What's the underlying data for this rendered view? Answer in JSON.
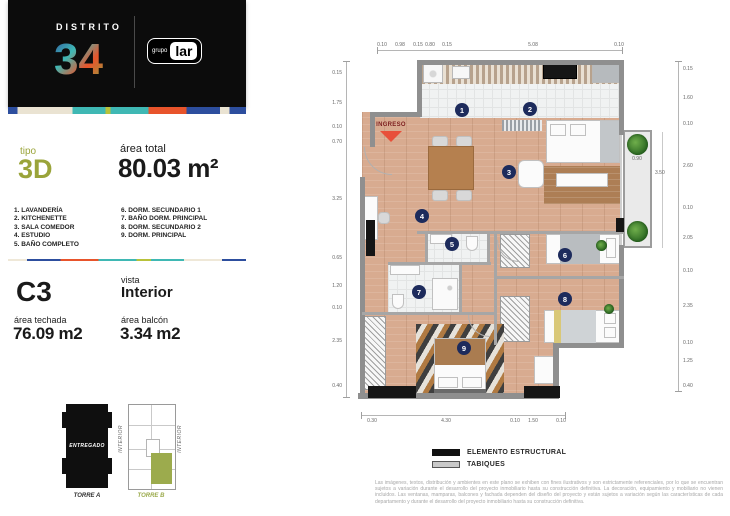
{
  "header": {
    "brand_top": "DISTRITO",
    "brand_number": "34",
    "partner_small": "grupo",
    "partner_main": "lar"
  },
  "summary": {
    "tipo_label": "tipo",
    "tipo_value": "3D",
    "area_total_label": "área total",
    "area_total_value": "80.03 m²"
  },
  "rooms_col1": [
    {
      "num": "1.",
      "name": "LAVANDERÍA"
    },
    {
      "num": "2.",
      "name": "KITCHENETTE"
    },
    {
      "num": "3.",
      "name": "SALA COMEDOR"
    },
    {
      "num": "4.",
      "name": "ESTUDIO"
    },
    {
      "num": "5.",
      "name": "BAÑO COMPLETO"
    }
  ],
  "rooms_col2": [
    {
      "num": "6.",
      "name": "DORM. SECUNDARIO 1"
    },
    {
      "num": "7.",
      "name": "BAÑO DORM. PRINCIPAL"
    },
    {
      "num": "8.",
      "name": "DORM. SECUNDARIO 2"
    },
    {
      "num": "9.",
      "name": "DORM. PRINCIPAL"
    }
  ],
  "unit": {
    "code": "C3",
    "vista_label": "vista",
    "vista_value": "Interior",
    "area_techada_label": "área techada",
    "area_techada_value": "76.09 m2",
    "area_balcon_label": "área balcón",
    "area_balcon_value": "3.34 m2"
  },
  "towers": {
    "torre_a_status": "ENTREGADO",
    "torre_a_caption": "TORRE A",
    "torre_b_caption": "TORRE B",
    "interior_left": "INTERIOR",
    "interior_right": "INTERIOR"
  },
  "floorplan": {
    "ingreso": "INGRESO",
    "room_numbers": [
      "1",
      "2",
      "3",
      "4",
      "5",
      "6",
      "7",
      "8",
      "9"
    ],
    "dims": {
      "top": [
        "0.10",
        "0.98",
        "0.15",
        "0.80",
        "0.15",
        "5.08",
        "0.10"
      ],
      "bottom": [
        "0.30",
        "4.30",
        "0.10",
        "1.50",
        "0.10"
      ],
      "left": [
        "0.15",
        "1.75",
        "0.10",
        "0.70",
        "3.25",
        "0.65",
        "1.20",
        "0.10",
        "2.35",
        "0.40"
      ],
      "right": [
        "0.15",
        "1.60",
        "0.10",
        "2.60",
        "0.10",
        "2.05",
        "0.10",
        "2.35",
        "0.10",
        "1.25",
        "0.40"
      ],
      "balcony_width": "0.90",
      "balcony_depth": "3.50"
    }
  },
  "plan_legend": {
    "structural": "ELEMENTO ESTRUCTURAL",
    "partitions": "TABIQUES"
  },
  "disclaimer": "Las imágenes, textos, distribución y ambientes en este plano se exhiben con fines ilustrativos y son estrictamente referenciales, por lo que se encuentran sujetos a variación durante el desarrollo del proyecto inmobiliario hasta su construcción definitiva. La decoración, equipamiento y mobiliario no vienen incluidos. Las ventanas, mamparas, balcones y fachada dependen del diseño del proyecto y están sujetos a variación según las características de cada departamento y durante el desarrollo del proyecto inmobiliario hasta su construcción definitiva.",
  "colors": {
    "accent_green": "#9aa43a",
    "navy": "#1d2b5c",
    "orange": "#e8542b",
    "teal": "#3fb8b4",
    "brand_blue": "#2d4e9e"
  }
}
